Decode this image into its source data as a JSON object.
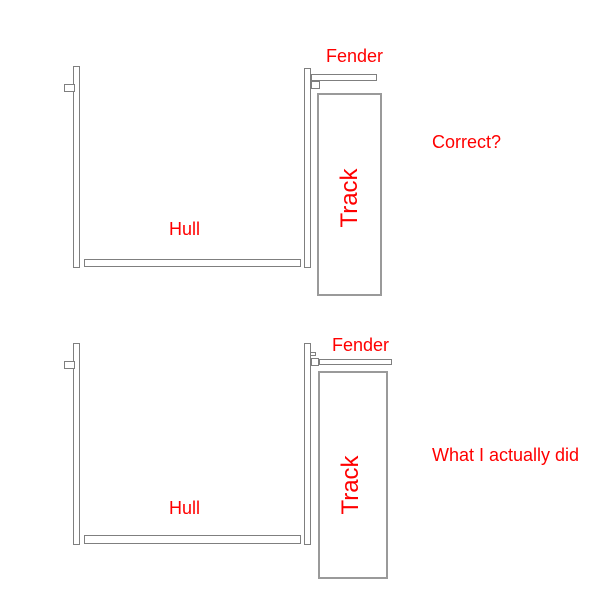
{
  "colors": {
    "background": "#ffffff",
    "outline": "#7f7f7f",
    "track_outline": "#9a9a9a",
    "label_red": "#ff0000"
  },
  "diagrams": [
    {
      "caption": "Correct?",
      "labels": {
        "fender": "Fender",
        "hull": "Hull",
        "track": "Track"
      }
    },
    {
      "caption": "What I actually did",
      "labels": {
        "fender": "Fender",
        "hull": "Hull",
        "track": "Track"
      }
    }
  ]
}
